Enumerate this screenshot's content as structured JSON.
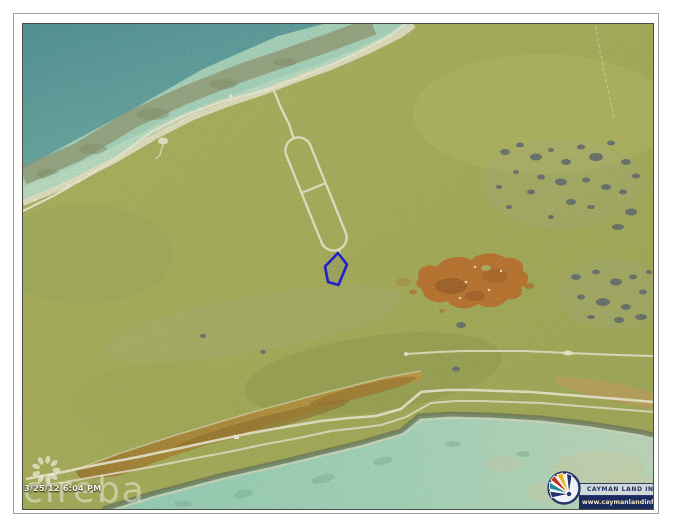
{
  "frame": {
    "background_color": "#ffffff",
    "outer_line_color": "#9aa0a0",
    "photo_border_color": "#4b4f42"
  },
  "photo": {
    "type": "aerial-orthophoto",
    "parcel": {
      "outline_color": "#2121cc"
    },
    "timestamp": "3/25/12 6:04 PM",
    "watermark": {
      "brand": "cireba",
      "color": "rgba(255,255,255,0.42)"
    },
    "branding": {
      "name": "CAYMAN LAND INFO",
      "url": "www.caymanlandinfo.ky",
      "name_color": "#1f2f66",
      "url_bar_color": "#1c2b5e",
      "url_text_color": "#f0e6be",
      "fan_colors": [
        "#24346a",
        "#2a8a9a",
        "#c23018",
        "#e8b21c"
      ]
    },
    "terrain_colors": {
      "land_olive": "#99a144",
      "ocean_deep": "#2f7f90",
      "shallow_turquoise": "#9ad0bd",
      "lagoon_brown": "#a0741c",
      "iron_patch_orange": "#b2590e",
      "pond_slate": "#46525c",
      "road_white": "#efe9d6"
    }
  }
}
